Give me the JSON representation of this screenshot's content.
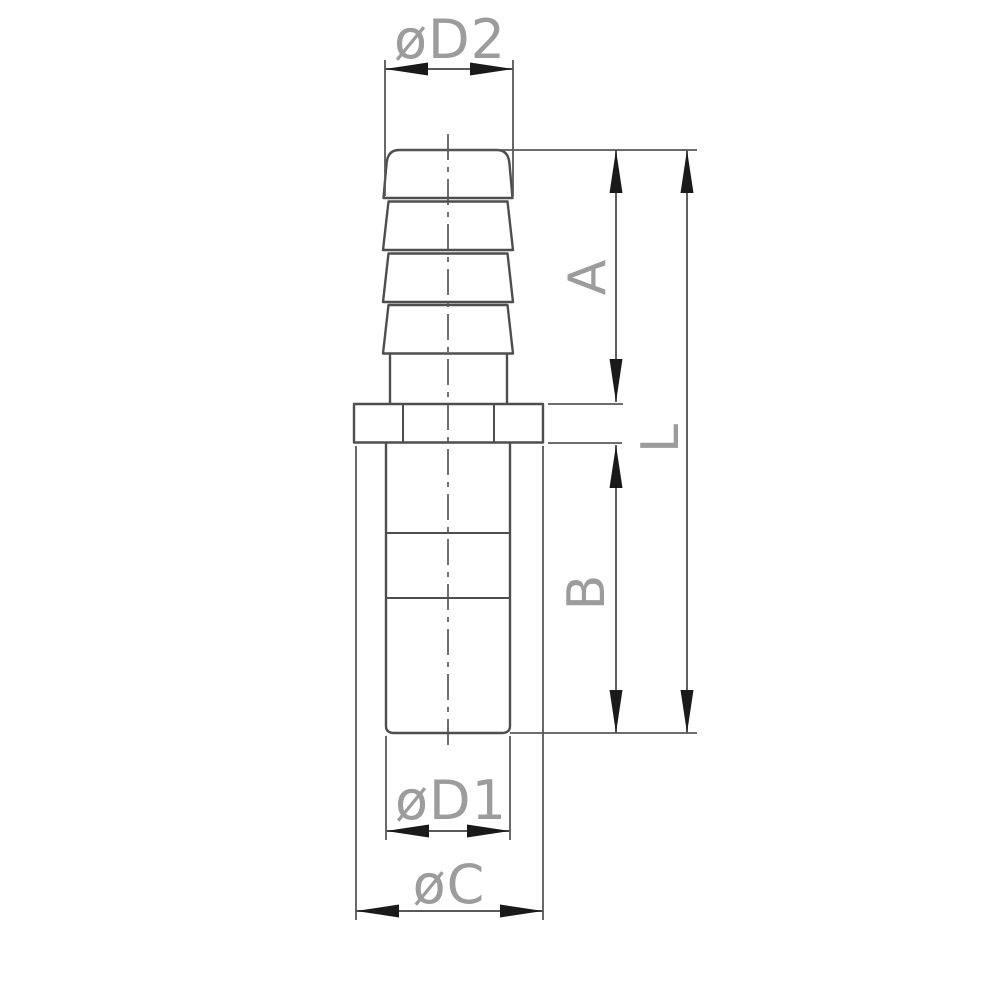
{
  "colors": {
    "line": "#4e4e4e",
    "dim": "#585858",
    "arrow": "#1a1a1a",
    "label": "#9c9c9c",
    "background": "#ffffff"
  },
  "drawing": {
    "labels": {
      "d2": "øD2",
      "a": "A",
      "l": "L",
      "b": "B",
      "d1": "øD1",
      "c": "øC"
    }
  }
}
